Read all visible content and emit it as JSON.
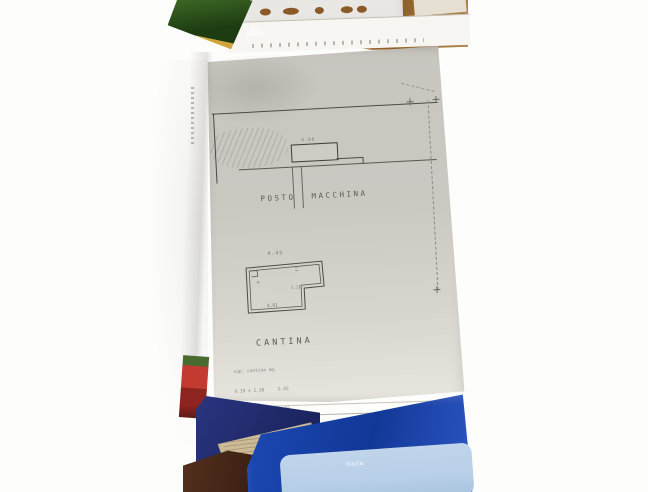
{
  "plan": {
    "area_label": "POSTO MACCHINA",
    "room_label": "CANTINA",
    "dims": {
      "rect_top": "5.00",
      "cantina_top": "4.45",
      "cantina_bottom": "4.01",
      "cantina_notch": "1.11",
      "cantina_mark": "≡"
    },
    "calc": {
      "rows": [
        "sup. cantina mq.",
        "4.19 x 1.30     5.45",
        "4.01 x 4.42    17.72",
        "4.10 x 1.62     6.64",
        "1.96 x 1.75     3.43",
        "1.10 x 1.30 :2  0.72"
      ],
      "total": "29.15"
    }
  },
  "folder": {
    "label_text": "Italia"
  },
  "colors": {
    "wood": "#9b6a33",
    "wood-dark": "#7a4f1e",
    "copy-gray": "#c8c5bf",
    "copy-light": "#e6e3dc",
    "line-dark": "#4a4a46",
    "line-faint": "#8a8a84",
    "green": "#33591f",
    "mustard": "#d2a43c",
    "red-book": "#c23a30",
    "navy": "#232d74",
    "tan": "#cdbb98",
    "desk-dark": "#3a2013",
    "folder-blue": "#1c49b4",
    "label-blue": "#b8cfe8",
    "pencil": "#7d7d85"
  }
}
